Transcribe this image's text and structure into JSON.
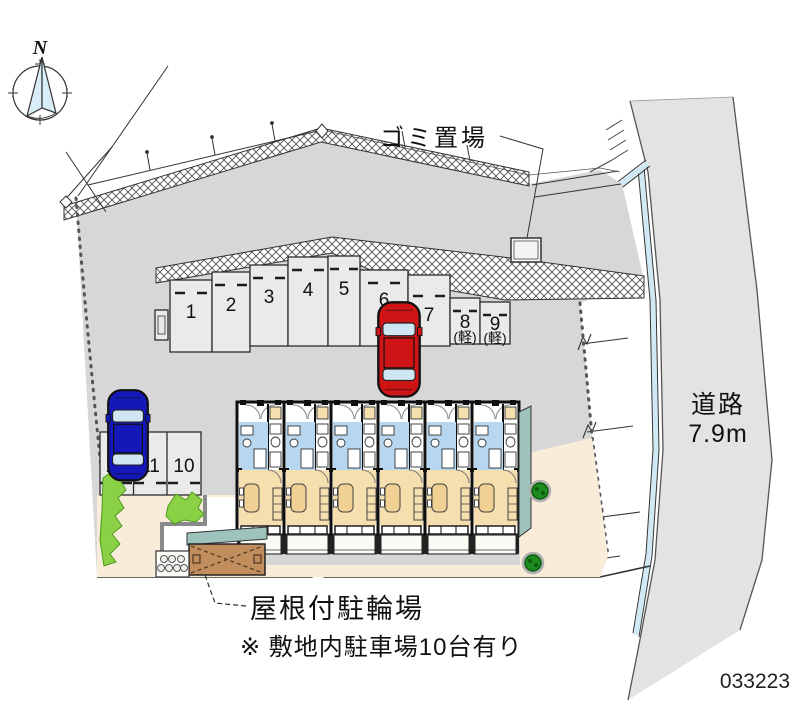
{
  "compass": {
    "north_label": "N"
  },
  "labels": {
    "garbage_area": "ゴミ置場",
    "road_name": "道路",
    "road_width": "7.9m",
    "covered_bicycle_parking": "屋根付駐輪場",
    "site_note": "※ 敷地内駐車場10台有り",
    "plan_number": "033223"
  },
  "parking": {
    "spaces": [
      {
        "label": "1"
      },
      {
        "label": "2"
      },
      {
        "label": "3"
      },
      {
        "label": "4"
      },
      {
        "label": "5"
      },
      {
        "label": "6",
        "occupied_by": "red-car"
      },
      {
        "label": "7"
      },
      {
        "label": "8",
        "type_label": "(軽)"
      },
      {
        "label": "9",
        "type_label": "(軽)"
      },
      {
        "label": "10"
      },
      {
        "label": "11"
      },
      {
        "label": "12",
        "occupied_by": "blue-car"
      }
    ]
  },
  "vehicles": [
    {
      "name": "red-car",
      "color": "#cf1416"
    },
    {
      "name": "blue-car",
      "color": "#1518b8"
    }
  ],
  "colors": {
    "site_ground": "#d7d7d7",
    "road_surface": "#e3e3e3",
    "parking_space": "#eaeaea",
    "building_wet_area_blue": "#b7d7f1",
    "building_room_beige": "#f6dfae",
    "walkway_beige": "#f9ecd9",
    "building_edge_teal": "#9dc3bc",
    "shrub_green": "#8bd146",
    "tree_green": "#1f8a1f",
    "bike_shed_brown": "#c28d5c",
    "water_channel_blue": "#cfeaf5"
  }
}
